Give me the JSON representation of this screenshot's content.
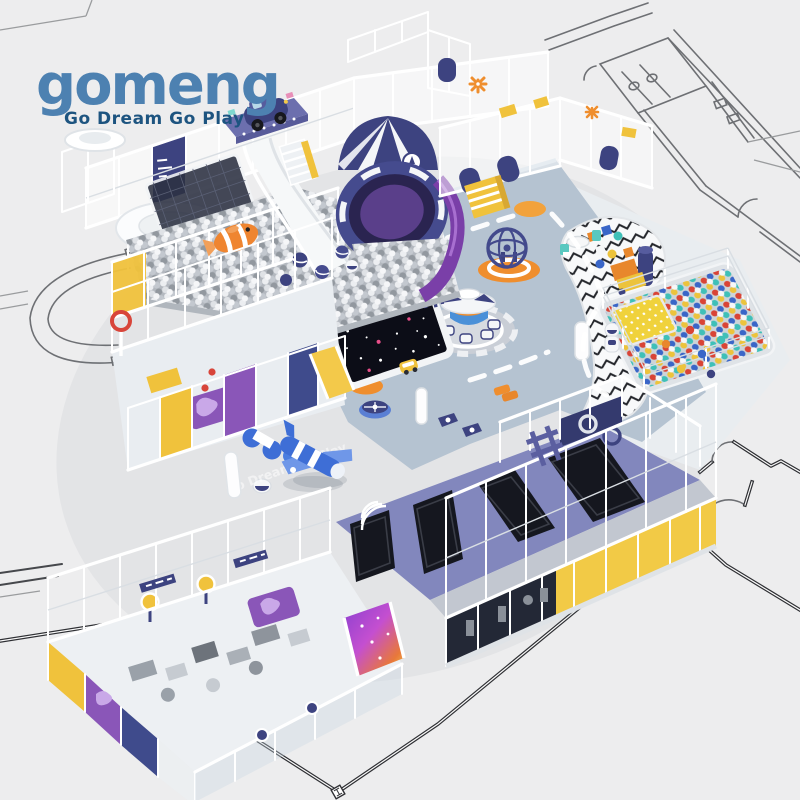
{
  "page": {
    "background_color": "#ededee"
  },
  "logo": {
    "brand": "gomeng",
    "tagline": "Go Dream Go Play",
    "brand_color": "#4d81b1",
    "tagline_color": "#1d5480"
  },
  "floor_watermark": {
    "text": "Go Dream Go Play"
  },
  "palette": {
    "frame_white": "#ffffff",
    "floor_blue": "#b5c3d1",
    "navy": "#3d4380",
    "periwinkle": "#8287bd",
    "purple_panel": "#8a56b8",
    "yellow": "#f3c94a",
    "orange_mat": "#ef8e2e",
    "trampoline_black": "#15171f",
    "silver_ball": "#c9cbd1",
    "glass_blue": "#cfe2ea",
    "plan_line": "#3c3c3c",
    "inflatable_blue": "#3e6ed6",
    "teal": "#6fd3cc",
    "slide_magenta": "#c04fd0"
  },
  "scene": {
    "elements": [
      "architectural-floorplan-background",
      "silver-ball-pit-with-rocket-slide",
      "white-wave-slide",
      "toddler-soft-play-structure",
      "space-carousel-and-globe-climber",
      "starfield-interactive-mat",
      "chevron-pattern-play-zone",
      "color-ball-pit",
      "trampoline-court",
      "ninja-obstacle-structure",
      "inflatable-airplane",
      "clownfish-float",
      "kiddie-car-ride"
    ]
  }
}
